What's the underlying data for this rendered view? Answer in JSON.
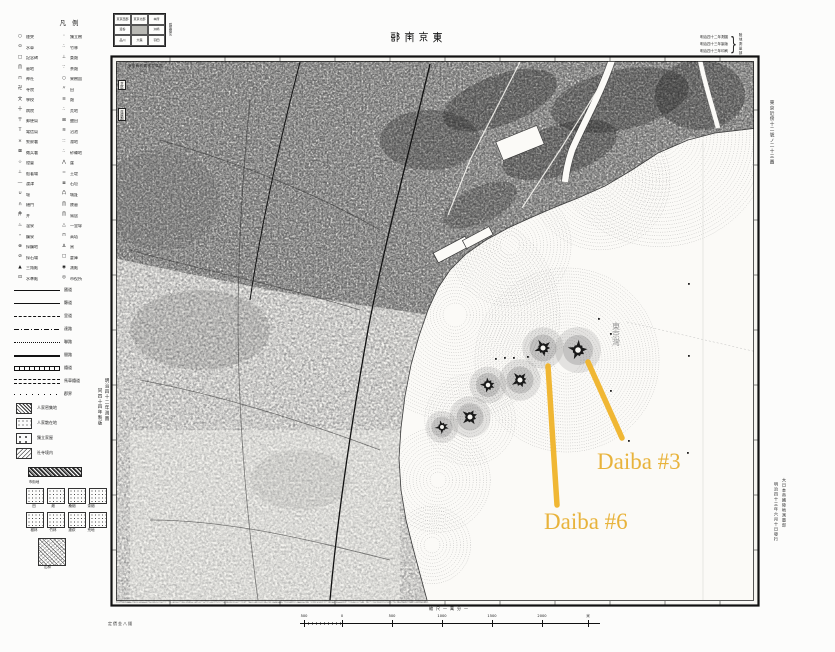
{
  "map": {
    "title": "東京南部",
    "title_display": "部 南 京 東",
    "bay_label": "東京灣",
    "margin_right_note": "東京近傍十二號ノ二十三圖",
    "margin_left_note_1": "明治四十二年測圖",
    "margin_left_note_2": "同四十四年製版",
    "publisher_note_1": "大日本帝國陸地測量部",
    "publisher_note_2": "明治四十三年六月十日發行",
    "under_left_note": "定價金八錢",
    "inmap_top_note": "東京府武藏國荏原郡",
    "inmap_boxes": [
      "芝區",
      "荏原郡"
    ]
  },
  "note_top_right": {
    "lines": [
      "明治四十二年測圖",
      "明治四十三年製版",
      "明治四十三年印刷"
    ],
    "right_text": "陸地測量部"
  },
  "index_grid": {
    "side_label": "隣接圖名",
    "shaded_index": 4,
    "cells": [
      "東京西部",
      "東京北部",
      "本所",
      "澁谷",
      "東京南部",
      "洲崎",
      "品川",
      "大森",
      "羽田"
    ]
  },
  "legend": {
    "header": "凡例",
    "pairs": [
      [
        "○",
        "煙突",
        "◦",
        "獨立樹"
      ],
      [
        "⊙",
        "水車",
        "∴",
        "竹林"
      ],
      [
        "□",
        "記念碑",
        "⊥",
        "桑畑"
      ],
      [
        "∏",
        "墓地",
        "∵",
        "茶畑"
      ],
      [
        "⊓",
        "神社",
        "○",
        "果樹園"
      ],
      [
        "卍",
        "寺院",
        "〃",
        "田"
      ],
      [
        "文",
        "學校",
        "≡",
        "畑"
      ],
      [
        "十",
        "病院",
        "∴",
        "荒地"
      ],
      [
        "〒",
        "郵便局",
        "⊞",
        "鹽田"
      ],
      [
        "T",
        "電信局",
        "≋",
        "沼池"
      ],
      [
        "×",
        "警察署",
        "∷",
        "濕地"
      ],
      [
        "⊠",
        "徴兵署",
        "∴",
        "砂礫地"
      ],
      [
        "☆",
        "燈臺",
        "⋀",
        "崖"
      ],
      [
        "⊥",
        "船著場",
        "=",
        "土堤"
      ],
      [
        "―",
        "渡津",
        "≣",
        "石垣"
      ],
      [
        "∪",
        "堰",
        "凸",
        "城趾"
      ],
      [
        "∩",
        "樋門",
        "∏",
        "陵墓"
      ],
      [
        "井",
        "井",
        "∏",
        "鳥居"
      ],
      [
        "♨",
        "温泉",
        "△",
        "一里塚"
      ],
      [
        "∘",
        "鑛泉",
        "⊓",
        "高塔"
      ],
      [
        "⊗",
        "採鑛地",
        "∆",
        "窯"
      ],
      [
        "⊘",
        "採石場",
        "□",
        "倉庫"
      ],
      [
        "▲",
        "三角點",
        "◉",
        "測點"
      ],
      [
        "⊡",
        "水準點",
        "◎",
        "市役所"
      ]
    ],
    "line_rows": [
      {
        "style": "solid-thick",
        "label": "國道"
      },
      {
        "style": "solid",
        "label": "縣道"
      },
      {
        "style": "dashed",
        "label": "里道"
      },
      {
        "style": "dashdot",
        "label": "達路"
      },
      {
        "style": "dotted",
        "label": "聯路"
      },
      {
        "style": "double",
        "label": "間路"
      },
      {
        "style": "rail",
        "label": "鐵道"
      },
      {
        "style": "double-dash",
        "label": "馬車鐵道"
      },
      {
        "style": "dot-sparse",
        "label": "郡界"
      }
    ],
    "extra_rows": [
      {
        "sample": "dense",
        "label": "人家密集地"
      },
      {
        "sample": "sparse",
        "label": "人家散在地"
      },
      {
        "sample": "dot",
        "label": "獨立家屋"
      },
      {
        "sample": "hatch",
        "label": "社寺境内"
      }
    ],
    "patterns": {
      "bar_label": "市街地",
      "row1": [
        "田",
        "畑",
        "桑畑",
        "茶畑"
      ],
      "row2": [
        "樹林",
        "竹林",
        "蘆荻",
        "荒地"
      ],
      "big_label": "山林"
    }
  },
  "scale_bar": {
    "caption": "縮尺一萬分一",
    "ticks": [
      {
        "t": "500",
        "x": 4
      },
      {
        "t": "0",
        "x": 42
      },
      {
        "t": "500",
        "x": 92
      },
      {
        "t": "1000",
        "x": 142
      },
      {
        "t": "1500",
        "x": 192
      },
      {
        "t": "2000",
        "x": 242
      },
      {
        "t": "米",
        "x": 288
      }
    ]
  },
  "annotations": {
    "label_color": "#E8B33B",
    "line_color": "#F0B42A",
    "items": [
      {
        "label": "Daiba #3",
        "label_x": 597,
        "label_y": 449,
        "x1": 588,
        "y1": 362,
        "x2": 622,
        "y2": 438
      },
      {
        "label": "Daiba #6",
        "label_x": 544,
        "label_y": 509,
        "x1": 548,
        "y1": 366,
        "x2": 557,
        "y2": 505
      }
    ]
  },
  "map_art": {
    "paper": "#f6f5f1",
    "water_fill": "#fbfaf7",
    "shore_points": [
      [
        758,
        128
      ],
      [
        715,
        133
      ],
      [
        688,
        140
      ],
      [
        658,
        153
      ],
      [
        632,
        170
      ],
      [
        605,
        186
      ],
      [
        578,
        198
      ],
      [
        553,
        208
      ],
      [
        530,
        218
      ],
      [
        508,
        228
      ],
      [
        486,
        240
      ],
      [
        466,
        254
      ],
      [
        450,
        270
      ],
      [
        438,
        288
      ],
      [
        428,
        310
      ],
      [
        419,
        336
      ],
      [
        411,
        365
      ],
      [
        405,
        396
      ],
      [
        401,
        428
      ],
      [
        399,
        458
      ],
      [
        401,
        490
      ],
      [
        406,
        520
      ],
      [
        413,
        548
      ],
      [
        420,
        574
      ],
      [
        427,
        600
      ]
    ],
    "urban_poly": [
      [
        114,
        59
      ],
      [
        756,
        59
      ],
      [
        756,
        130
      ],
      [
        688,
        138
      ],
      [
        630,
        172
      ],
      [
        575,
        200
      ],
      [
        520,
        222
      ],
      [
        468,
        254
      ],
      [
        444,
        282
      ],
      [
        430,
        315
      ],
      [
        360,
        305
      ],
      [
        270,
        290
      ],
      [
        180,
        272
      ],
      [
        114,
        258
      ]
    ],
    "ring_fields": [
      {
        "cx": 455,
        "cy": 315,
        "r0": 12,
        "r1": 105,
        "step": 3.2
      },
      {
        "cx": 567,
        "cy": 360,
        "r0": 14,
        "r1": 92,
        "step": 3.0
      },
      {
        "cx": 470,
        "cy": 420,
        "r0": 10,
        "r1": 48,
        "step": 3.2
      },
      {
        "cx": 510,
        "cy": 245,
        "r0": 10,
        "r1": 62,
        "step": 3.4
      },
      {
        "cx": 660,
        "cy": 135,
        "r0": 18,
        "r1": 115,
        "step": 3.6
      },
      {
        "cx": 600,
        "cy": 180,
        "r0": 12,
        "r1": 70,
        "step": 3.4
      },
      {
        "cx": 438,
        "cy": 480,
        "r0": 8,
        "r1": 55,
        "step": 3.4
      },
      {
        "cx": 432,
        "cy": 545,
        "r0": 8,
        "r1": 40,
        "step": 3.4
      }
    ],
    "islands": [
      {
        "x": 543,
        "y": 348,
        "r": 9
      },
      {
        "x": 578,
        "y": 350,
        "r": 10
      },
      {
        "x": 520,
        "y": 380,
        "r": 9
      },
      {
        "x": 488,
        "y": 385,
        "r": 8
      },
      {
        "x": 470,
        "y": 417,
        "r": 9
      },
      {
        "x": 442,
        "y": 427,
        "r": 7
      }
    ],
    "dots": [
      [
        495,
        358
      ],
      [
        504,
        357
      ],
      [
        513,
        357
      ],
      [
        527,
        356
      ],
      [
        598,
        318
      ],
      [
        610,
        333
      ],
      [
        610,
        390
      ],
      [
        628,
        440
      ],
      [
        688,
        283
      ],
      [
        688,
        355
      ],
      [
        687,
        452
      ]
    ],
    "ticks_x": [
      170,
      225,
      280,
      335,
      390,
      445,
      500,
      555,
      610,
      665,
      720
    ],
    "ticks_y": [
      110,
      165,
      220,
      275,
      330,
      385,
      440,
      495,
      550
    ]
  }
}
